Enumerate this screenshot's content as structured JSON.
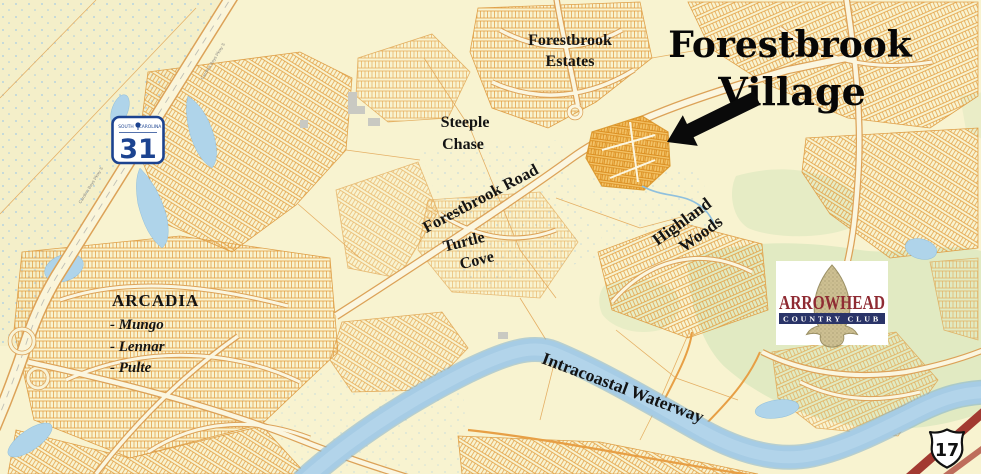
{
  "map": {
    "callout": {
      "line1": "Forestbrook",
      "line2": "Village"
    },
    "region_labels": {
      "forestbrook_estates": [
        "Forestbrook",
        "Estates"
      ],
      "steeple_chase": [
        "Steeple",
        "Chase"
      ],
      "turtle_cove": [
        "Turtle",
        "Cove"
      ],
      "highland_woods": [
        "Highland",
        "Woods"
      ],
      "arcadia": {
        "title": "ARCADIA",
        "builders": [
          "- Mungo",
          "- Lennar",
          "- Pulte"
        ]
      }
    },
    "road_labels": {
      "forestbrook_road": "Forestbrook Road",
      "intracoastal_waterway": "Intracoastal Waterway",
      "carolina_bays_pkwy": "Carolina Bays Pkwy S"
    },
    "route_shields": {
      "sc31": {
        "state_left": "SOUTH",
        "state_right": "CAROLINA",
        "number": "31"
      },
      "us17": {
        "number": "17"
      }
    },
    "arrowhead_logo": {
      "name": "ARROWHEAD",
      "subtitle": "COUNTRY CLUB"
    },
    "colors": {
      "background": "#F8F3D0",
      "parcel_orange": "#E39C3F",
      "village_highlight": "#F0AE45",
      "water_blue": "#A6CCE5",
      "golf_green": "#E1EAC2",
      "shield_blue": "#1C4390",
      "logo_maroon": "#8F2B33",
      "logo_navy": "#2A3468",
      "highway_red": "#A23A31",
      "arrow_black": "#0A0A0A"
    }
  }
}
